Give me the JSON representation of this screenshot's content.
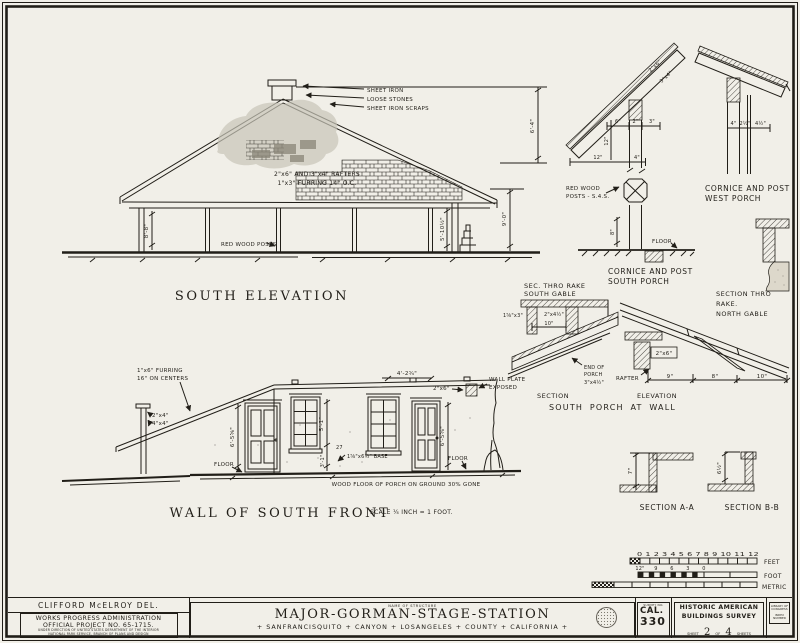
{
  "south_elevation": {
    "title": "SOUTH ELEVATION",
    "chimney_note_1": "SHEET IRON",
    "chimney_note_2": "LOOSE STONES",
    "chimney_note_3": "SHEET IRON SCRAPS",
    "rafter_note_1": "2\"x6\" AND 3\"x4\" RAFTERS",
    "rafter_note_2": "1\"x3\" FURRING 14\" O.C.",
    "posts_note": "RED WOOD POSTS",
    "dim_wall_left": "8'-8\"",
    "dim_wall_right": "5'-10½\"",
    "dim_height": "9'-0\"",
    "dim_roof": "6'-4\""
  },
  "wall_front": {
    "title": "WALL OF SOUTH FRONT",
    "scale_note": "SCALE ¼ INCH = 1 FOOT.",
    "furring_note_1": "1\"x6\" FURRING",
    "furring_note_2": "16\" ON CENTERS",
    "post_note_1": "2\"x4\"",
    "post_note_2": "4\"x4\"",
    "floor_label_left": "FLOOR",
    "floor_label_right": "FLOOR",
    "dim_door_left": "6'-5⅝\"",
    "dim_window": "5'-1\"",
    "dim_sill": "3'-1\"",
    "dim_door_right": "6'-5⅝\"",
    "dim_top": "4'-2¾\"",
    "plate_note": "2\"x6\"",
    "wall_plate_1": "WALL PLATE",
    "wall_plate_2": "EXPOSED",
    "base_num": "27",
    "base_note": "1⅝\"x6½\" BASE",
    "porch_note": "WOOD FLOOR OF PORCH ON GROUND 30% GONE"
  },
  "cornice_south": {
    "title_1": "CORNICE AND POST",
    "title_2": "SOUTH PORCH",
    "posts_note_1": "RED WOOD",
    "posts_note_2": "POSTS - S.4.S.",
    "floor_label": "FLOOR",
    "dim_6": "6\"",
    "dim_2": "2\"",
    "dim_3": "3\"",
    "dim_12v": "12\"",
    "dim_12h": "12\"",
    "dim_4": "4\"",
    "dim_8": "8\"",
    "rafter_label_1": "2\"x6\"",
    "rafter_label_2": "3\"x4\""
  },
  "cornice_west": {
    "title_1": "CORNICE AND POST",
    "title_2": "WEST PORCH",
    "dim_4": "4\"",
    "dim_2h": "2½\"",
    "dim_4h": "4½\""
  },
  "rake_south": {
    "title_1": "SEC. THRO RAKE",
    "title_2": "SOUTH GABLE",
    "dim_1x3": "1⅝\"x3\"",
    "dim_2x4": "2\"x4½\"",
    "dim_10": "10\""
  },
  "rake_north": {
    "title_1": "SECTION THRO",
    "title_2": "RAKE.",
    "title_3": "NORTH GABLE"
  },
  "porch_wall": {
    "caption_section": "SECTION",
    "caption_elevation": "ELEVATION",
    "caption_main": "SOUTH PORCH AT WALL",
    "end_note_1": "END OF",
    "end_note_2": "PORCH",
    "end_note_3": "3\"x4½\"",
    "rafter_label": "RAFTER",
    "plate_label": "2\"x6\"",
    "dim_9": "9\"",
    "dim_8": "8\"",
    "dim_10": "10\""
  },
  "section_aa": {
    "title": "SECTION A-A",
    "dim": "7\""
  },
  "section_bb": {
    "title": "SECTION B-B",
    "dim": "6½\""
  },
  "scales": {
    "feet_numbers": "0 1 2 3 4 5 6 7 8 9 10 11 12",
    "feet_label": "FEET",
    "foot_ticks": [
      "12\"",
      "9",
      "6",
      "3",
      "0"
    ],
    "foot_label": "FOOT",
    "metric_label": "METRIC"
  },
  "title_block": {
    "delineator": "CLIFFORD McELROY DEL.",
    "wpa_1": "WORKS PROGRESS ADMINISTRATION",
    "wpa_2": "OFFICIAL PROJECT NO. 65-1715.",
    "wpa_3": "UNDER DIRECTION OF UNITED STATES DEPARTMENT OF THE INTERIOR",
    "wpa_4": "NATIONAL PARK SERVICE, BRANCH OF PLANS AND DESIGN",
    "name_label": "NAME OF STRUCTURE",
    "structure_name": "MAJOR-GORMAN-STAGE-STATION",
    "structure_location": "+ SANFRANCISQUITO + CANYON + LOSANGELES + COUNTY + CALIFORNIA +",
    "survey_label": "SURVEY NO.",
    "survey_state": "CAL.",
    "survey_number": "330",
    "habs_1": "HISTORIC AMERICAN",
    "habs_2": "BUILDINGS SURVEY",
    "sheet_word": "SHEET",
    "sheet_no": "2",
    "of_word": "OF",
    "sheet_total": "4",
    "sheets_word": "SHEETS",
    "loc_1": "LIBRARY OF CONGRESS",
    "loc_2": "INDEX NUMBER"
  }
}
